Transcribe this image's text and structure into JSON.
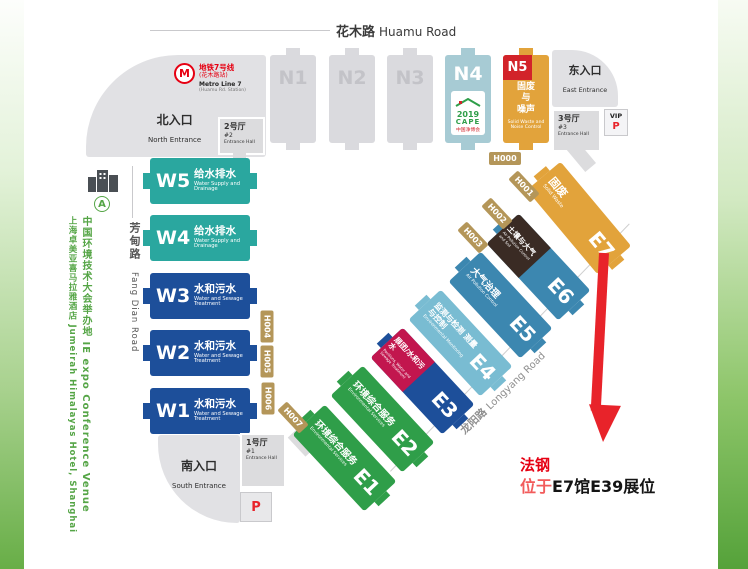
{
  "roads": {
    "huamu": {
      "zh": "花木路",
      "en": "Huamu Road"
    },
    "fangdian": {
      "zh": "芳甸路",
      "en": "Fang Dian Road"
    },
    "longyang": {
      "zh": "龙阳路",
      "en": "Longyang Road"
    }
  },
  "metro": {
    "line_zh": "地铁7号线",
    "station_zh": "(花木路站)",
    "line_en": "Metro Line 7",
    "station_en": "(Huamu Rd. Station)"
  },
  "entrances": {
    "north": {
      "zh": "北入口",
      "en": "North Entrance"
    },
    "east": {
      "zh": "东入口",
      "en": "East Entrance"
    },
    "south": {
      "zh": "南入口",
      "en": "South Entrance"
    }
  },
  "entrance_halls": {
    "hall1": {
      "zh": "1号厅",
      "num": "#1",
      "en": "Entrance Hall"
    },
    "hall2": {
      "zh": "2号厅",
      "num": "#2",
      "en": "Entrance Hall"
    },
    "hall3": {
      "zh": "3号厅",
      "num": "#3",
      "en": "Entrance Hall"
    }
  },
  "parking": {
    "vip_label": "VIP",
    "p_label": "P"
  },
  "n4_logo": {
    "year": "2019",
    "name": "CAPE",
    "sub": "中国净博会"
  },
  "halls": {
    "n1": {
      "label": "N1"
    },
    "n2": {
      "label": "N2"
    },
    "n3": {
      "label": "N3"
    },
    "n4": {
      "label": "N4"
    },
    "n5": {
      "label": "N5",
      "zh1": "固废",
      "zh2": "与",
      "zh3": "噪声",
      "en": "Solid Waste and Noise Control"
    },
    "w5": {
      "label": "W5",
      "zh": "给水排水",
      "en": "Water Supply and Drainage"
    },
    "w4": {
      "label": "W4",
      "zh": "给水排水",
      "en": "Water Supply and Drainage"
    },
    "w3": {
      "label": "W3",
      "zh": "水和污水",
      "en": "Water and Sewage Treatment"
    },
    "w2": {
      "label": "W2",
      "zh": "水和污水",
      "en": "Water and Sewage Treatment"
    },
    "w1": {
      "label": "W1",
      "zh": "水和污水",
      "en": "Water and Sewage Treatment"
    },
    "e1": {
      "label": "E1",
      "zh": "环境综合服务",
      "en": "Environmental Services"
    },
    "e2": {
      "label": "E2",
      "zh": "环境综合服务",
      "en": "Environmental Services"
    },
    "e3": {
      "label": "E3",
      "header_zh": "展团/水和污水",
      "header_en": "Pavilions, Water and Sewage Treatment"
    },
    "e4": {
      "label": "E4",
      "zh": "监测与检测 测量与控制",
      "en": "Environmental Monitoring"
    },
    "e5": {
      "label": "E5",
      "zh": "大气治理",
      "en": "Air Pollution Control"
    },
    "e6": {
      "label": "E6",
      "header_zh": "土壤与大气",
      "header_en": "Air Pollution Control and Soil"
    },
    "e7": {
      "label": "E7",
      "zh": "固废",
      "en": "Solid Waste"
    }
  },
  "corridors": {
    "h000": "H000",
    "h001": "H001",
    "h002": "H002",
    "h003": "H003",
    "h004": "H004",
    "h005": "H005",
    "h006": "H006",
    "h007": "H007"
  },
  "venue_note": {
    "marker": "A",
    "line1": "中国环境技术大会举办地 IE expo Conference Venue",
    "line2": "上海卓美亚喜马拉雅酒店 Jumeirah Himalayas Hotel, Shanghai"
  },
  "annotation": {
    "company": "法钢",
    "location_prefix": "位于",
    "booth": "E7馆E39展位"
  },
  "icons": {
    "metro": "shanghai-metro-logo",
    "building": "hotel-building-icon",
    "marker": "venue-marker-a",
    "arrow": "booth-pointer-arrow",
    "cape_roof": "cape-house-roof-icon"
  },
  "colors": {
    "teal": "#2aa79f",
    "dark_blue": "#1d4f9a",
    "green": "#2f9e49",
    "crimson": "#c2164e",
    "light_blue": "#79bcd2",
    "mid_blue": "#3c87b0",
    "brown": "#3a2b24",
    "orange": "#e2a33b",
    "n4_blue": "#a7cbd4",
    "badge_red": "#d2232a",
    "gold": "#b49659",
    "note_red": "#e60012",
    "sidebar_green": "#55a546",
    "hall_gray": "#dadade"
  }
}
